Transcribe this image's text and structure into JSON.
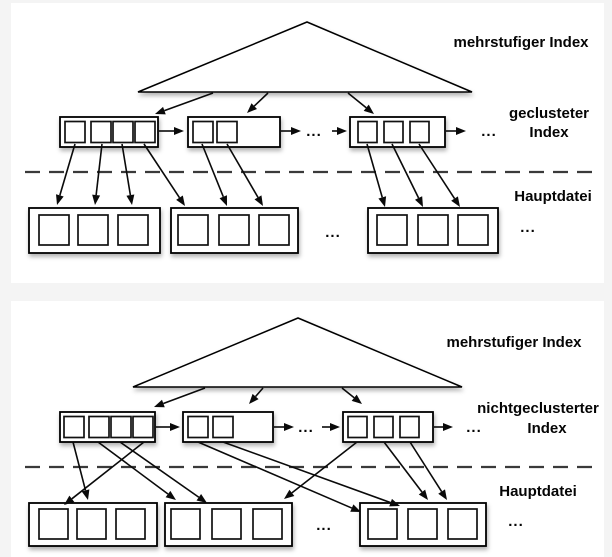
{
  "page": {
    "background_color": "#f4f4f4",
    "panel_color": "#ffffff",
    "ink_color": "#000000"
  },
  "panels": [
    {
      "id": "clustered",
      "top_label": "mehrstufiger Index",
      "mid_label_line1": "geclusteter",
      "mid_label_line2": "Index",
      "bottom_label": "Hauptdatei",
      "ellipsis": "...",
      "index_blocks": [
        {
          "cells": 4
        },
        {
          "cells": 2
        },
        {
          "cells": 3
        }
      ],
      "file_blocks": [
        {
          "cells": 3
        },
        {
          "cells": 3
        },
        {
          "cells": 3
        }
      ]
    },
    {
      "id": "nonclustered",
      "top_label": "mehrstufiger Index",
      "mid_label_line1": "nichtgeclusterter",
      "mid_label_line2": "Index",
      "bottom_label": "Hauptdatei",
      "ellipsis": "...",
      "index_blocks": [
        {
          "cells": 4
        },
        {
          "cells": 2
        },
        {
          "cells": 3
        }
      ],
      "file_blocks": [
        {
          "cells": 3
        },
        {
          "cells": 3
        },
        {
          "cells": 3
        }
      ]
    }
  ]
}
